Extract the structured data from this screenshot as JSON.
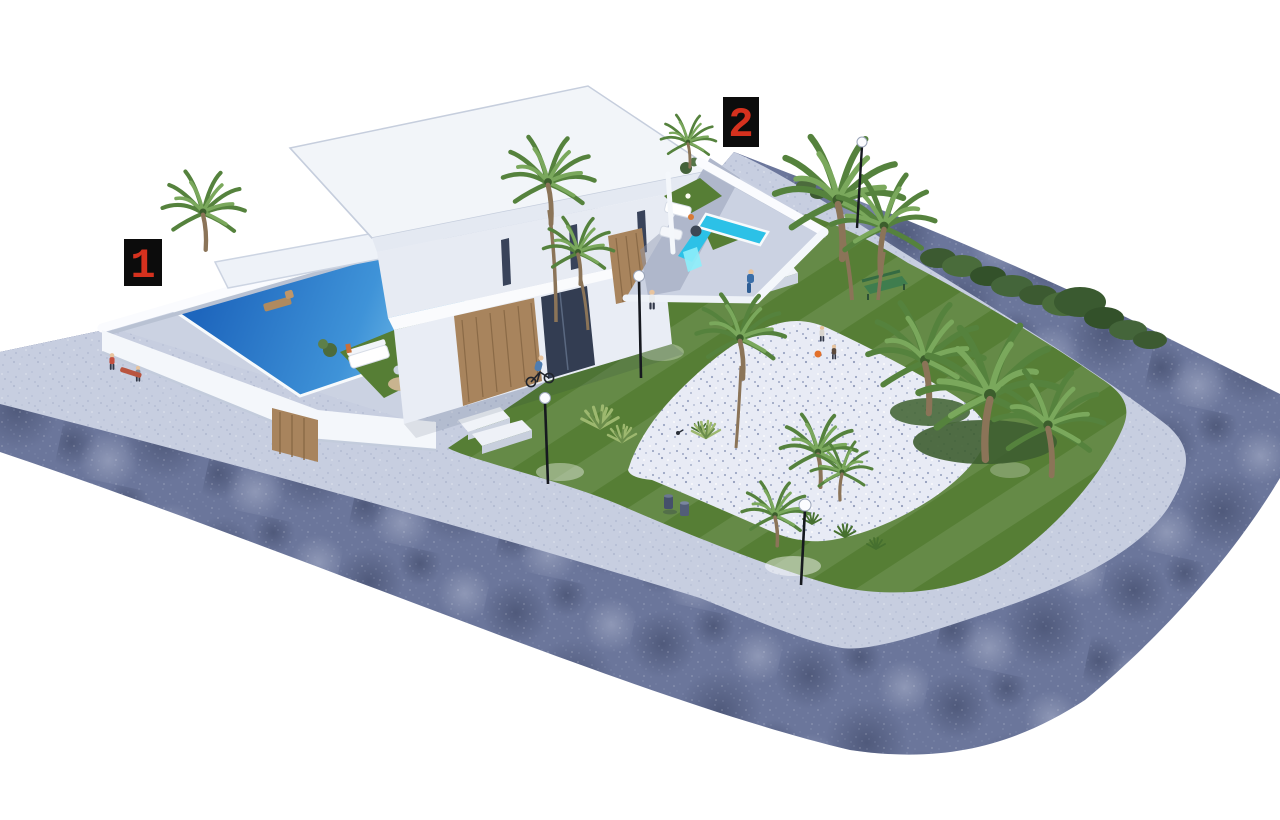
{
  "markers": [
    {
      "id": "plot-1",
      "label": "1"
    },
    {
      "id": "plot-2",
      "label": "2"
    }
  ],
  "palette": {
    "background": "#ffffff",
    "road": "#6b769b",
    "sidewalk": "#c7cee0",
    "gravel": "#e8ebf5",
    "lawn": "#567e35",
    "deck": "#cbd2e2",
    "building": "#f2f5f9",
    "building_shade": "#e7ebf3",
    "wood": "#a8845d",
    "pool_deep": "#1e66bd",
    "pool_light": "#97d8f2",
    "pool_bright": "#2cc1e7",
    "hedge": "#42603a",
    "palm": "#55823d",
    "lamp_pole": "#16191f",
    "bench_green": "#3f7d4e",
    "marker_bg": "#0c0c0c",
    "marker_red": "#d5311e",
    "people_blue": "#3a6ea8"
  }
}
